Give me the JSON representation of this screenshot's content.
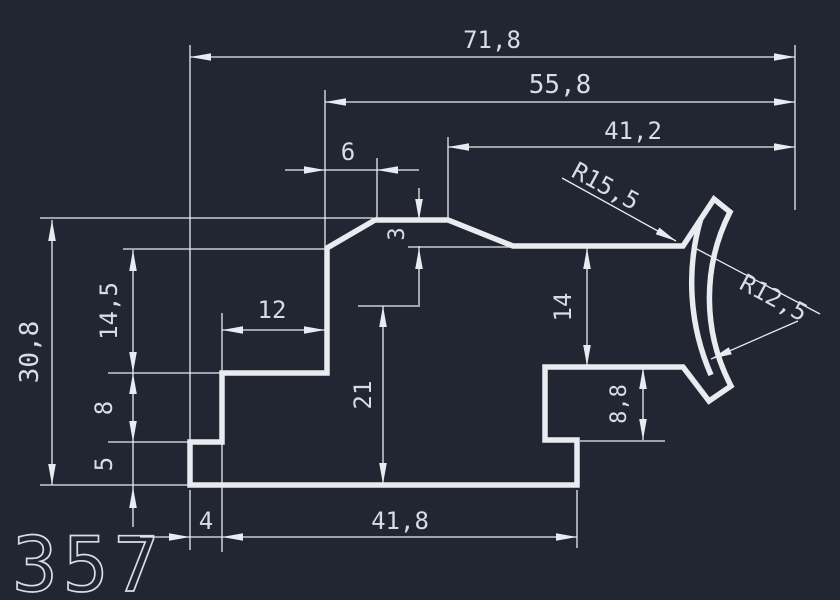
{
  "canvas": {
    "width": 840,
    "height": 600,
    "background_color": "#212632",
    "line_color": "#e9ebf0",
    "text_color": "#d8dce3",
    "profile_stroke_width": 5.5,
    "dim_stroke_width": 1.3
  },
  "drawing_number": "357",
  "profile": {
    "outline_path": "M 190 485 L 190 442 L 222 442 L 222 373 L 327 373 L 327 248 L 375 220 L 448 220 L 513 246 L 683 246 L 714 199 L 730 212 A 190 190 0 0 0 731 386 L 709 401 L 683 367 L 545 367 L 545 440 L 577 440 L 577 485 Z",
    "inner_cove_arc_path": "M 701 218 A 230 230 0 0 0 711 375"
  },
  "dimensions": {
    "linear": [
      {
        "value": "71,8",
        "orientation": "horizontal",
        "from_x": 190,
        "to_x": 795,
        "line_y": 57
      },
      {
        "value": "55,8",
        "orientation": "horizontal",
        "from_x": 325,
        "to_x": 795,
        "line_y": 102
      },
      {
        "value": "41,2",
        "orientation": "horizontal",
        "from_x": 448,
        "to_x": 795,
        "line_y": 147
      },
      {
        "value": "6",
        "orientation": "horizontal",
        "from_x": 325,
        "to_x": 377,
        "line_y": 170
      },
      {
        "value": "3",
        "orientation": "vertical",
        "from_y": 220,
        "to_y": 248,
        "line_x": 419
      },
      {
        "value": "30,8",
        "orientation": "vertical",
        "from_y": 220,
        "to_y": 485,
        "line_x": 52
      },
      {
        "value": "14,5",
        "orientation": "vertical",
        "from_y": 250,
        "to_y": 373,
        "line_x": 133
      },
      {
        "value": "8",
        "orientation": "vertical",
        "from_y": 373,
        "to_y": 442,
        "line_x": 133
      },
      {
        "value": "5",
        "orientation": "vertical",
        "from_y": 442,
        "to_y": 485,
        "line_x": 133
      },
      {
        "value": "12",
        "orientation": "horizontal",
        "from_x": 222,
        "to_x": 325,
        "line_y": 330
      },
      {
        "value": "21",
        "orientation": "vertical",
        "from_y": 306,
        "to_y": 484,
        "line_x": 383
      },
      {
        "value": "14",
        "orientation": "vertical",
        "from_y": 248,
        "to_y": 366,
        "line_x": 587
      },
      {
        "value": "8,8",
        "orientation": "vertical",
        "from_y": 368,
        "to_y": 440,
        "line_x": 643
      },
      {
        "value": "4",
        "orientation": "horizontal",
        "from_x": 190,
        "to_x": 222,
        "line_y": 537
      },
      {
        "value": "41,8",
        "orientation": "horizontal",
        "from_x": 222,
        "to_x": 577,
        "line_y": 537
      }
    ],
    "radial": [
      {
        "value": "R15,5"
      },
      {
        "value": "R12,5"
      }
    ]
  },
  "render": {
    "dim_lines": [
      [
        190,
        57,
        795,
        57
      ],
      [
        325,
        102,
        795,
        102
      ],
      [
        448,
        147,
        795,
        147
      ],
      [
        285,
        170,
        419,
        170
      ],
      [
        419,
        188,
        419,
        222
      ],
      [
        419,
        246,
        419,
        307
      ],
      [
        52,
        220,
        52,
        485
      ],
      [
        133,
        250,
        133,
        485
      ],
      [
        133,
        485,
        133,
        527
      ],
      [
        222,
        330,
        325,
        330
      ],
      [
        383,
        306,
        383,
        484
      ],
      [
        587,
        248,
        587,
        366
      ],
      [
        643,
        368,
        643,
        440
      ],
      [
        140,
        537,
        577,
        537
      ]
    ],
    "ext_lines": [
      [
        190,
        45,
        190,
        440
      ],
      [
        190,
        490,
        190,
        550
      ],
      [
        222,
        313,
        222,
        373
      ],
      [
        222,
        443,
        222,
        552
      ],
      [
        325,
        90,
        325,
        248
      ],
      [
        377,
        158,
        377,
        218
      ],
      [
        448,
        137,
        448,
        218
      ],
      [
        795,
        45,
        795,
        210
      ],
      [
        577,
        490,
        577,
        548
      ],
      [
        40,
        218,
        373,
        218
      ],
      [
        123,
        249,
        325,
        249
      ],
      [
        408,
        247,
        513,
        247
      ],
      [
        108,
        373,
        220,
        373
      ],
      [
        108,
        442,
        188,
        442
      ],
      [
        40,
        485,
        188,
        485
      ],
      [
        358,
        306,
        418,
        306
      ],
      [
        580,
        441,
        665,
        441
      ]
    ],
    "leader_lines": [
      [
        562,
        178,
        676,
        241
      ],
      [
        693,
        247,
        820,
        314
      ],
      [
        711,
        359,
        798,
        321
      ]
    ],
    "arrows": [
      [
        190,
        57,
        180
      ],
      [
        795,
        57,
        0
      ],
      [
        325,
        102,
        180
      ],
      [
        795,
        102,
        0
      ],
      [
        448,
        147,
        180
      ],
      [
        795,
        147,
        0
      ],
      [
        325,
        170,
        0
      ],
      [
        377,
        170,
        180
      ],
      [
        419,
        220,
        90
      ],
      [
        419,
        248,
        -90
      ],
      [
        52,
        220,
        -90
      ],
      [
        52,
        485,
        90
      ],
      [
        133,
        250,
        -90
      ],
      [
        133,
        373,
        90
      ],
      [
        133,
        373,
        -90
      ],
      [
        133,
        442,
        90
      ],
      [
        133,
        487,
        -90
      ],
      [
        222,
        330,
        180
      ],
      [
        325,
        330,
        0
      ],
      [
        383,
        306,
        -90
      ],
      [
        383,
        484,
        90
      ],
      [
        587,
        248,
        -90
      ],
      [
        587,
        366,
        90
      ],
      [
        643,
        368,
        -90
      ],
      [
        643,
        440,
        90
      ],
      [
        190,
        537,
        0
      ],
      [
        222,
        537,
        180
      ],
      [
        577,
        537,
        0
      ],
      [
        676,
        241,
        28.5
      ],
      [
        711,
        359,
        157
      ]
    ],
    "labels": [
      {
        "text": "71,8",
        "x": 492,
        "y": 48,
        "size": 24
      },
      {
        "text": "55,8",
        "x": 560,
        "y": 93,
        "size": 26
      },
      {
        "text": "41,2",
        "x": 633,
        "y": 139,
        "size": 24
      },
      {
        "text": "6",
        "x": 348,
        "y": 160,
        "size": 24
      },
      {
        "text": "3",
        "x": 404,
        "y": 234,
        "size": 22,
        "rotate": -90
      },
      {
        "text": "R15,5",
        "x": 570,
        "y": 176,
        "size": 24,
        "rotate": 28.5,
        "anchor": "start"
      },
      {
        "text": "R12,5",
        "x": 738,
        "y": 288,
        "size": 24,
        "rotate": 28,
        "anchor": "start"
      },
      {
        "text": "30,8",
        "x": 38,
        "y": 352,
        "size": 26,
        "rotate": -90
      },
      {
        "text": "14,5",
        "x": 117,
        "y": 311,
        "size": 24,
        "rotate": -90
      },
      {
        "text": "8",
        "x": 112,
        "y": 408,
        "size": 24,
        "rotate": -90
      },
      {
        "text": "5",
        "x": 112,
        "y": 464,
        "size": 24,
        "rotate": -90
      },
      {
        "text": "12",
        "x": 272,
        "y": 318,
        "size": 24
      },
      {
        "text": "21",
        "x": 371,
        "y": 395,
        "size": 24,
        "rotate": -90
      },
      {
        "text": "14",
        "x": 571,
        "y": 307,
        "size": 24,
        "rotate": -90
      },
      {
        "text": "8,8",
        "x": 626,
        "y": 404,
        "size": 22,
        "rotate": -90
      },
      {
        "text": "4",
        "x": 206,
        "y": 529,
        "size": 24
      },
      {
        "text": "41,8",
        "x": 400,
        "y": 529,
        "size": 24
      }
    ],
    "title_label": {
      "x": 12,
      "y": 591,
      "size": 76,
      "letter_spacing": 5,
      "stroke_width": 1.7
    }
  }
}
